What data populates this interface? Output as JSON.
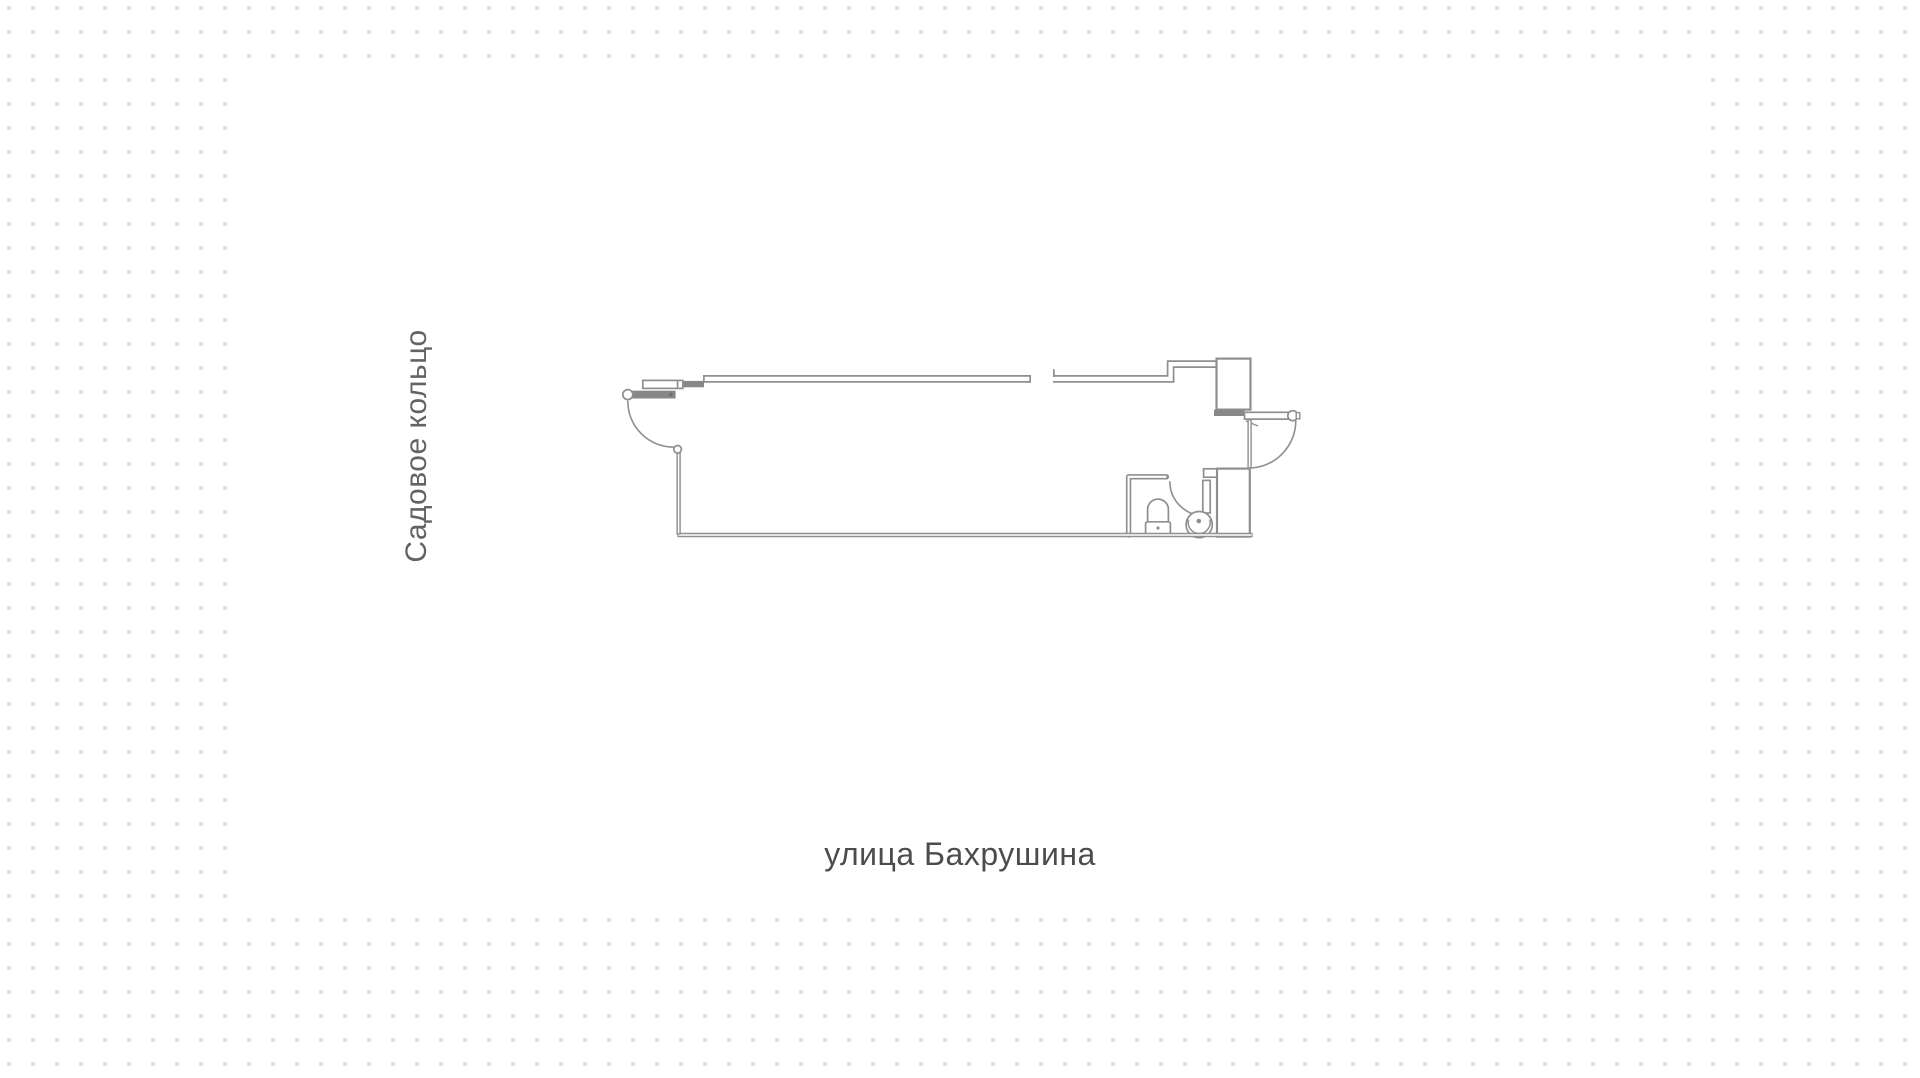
{
  "background": {
    "canvas_color": "#ffffff",
    "dot_color": "#e0e0e0",
    "dot_spacing_px": 24,
    "dot_size_px": 4
  },
  "labels": {
    "left_street": "Садовое кольцо",
    "bottom_street": "улица Бахрушина"
  },
  "plan": {
    "stroke_color": "#8f8f8f",
    "fill_color": "#ffffff",
    "rooms": [
      {
        "name": "main-hall"
      },
      {
        "name": "bathroom"
      }
    ],
    "doors": [
      {
        "name": "entrance-door-left"
      },
      {
        "name": "entrance-door-right"
      },
      {
        "name": "bathroom-door"
      }
    ],
    "fixtures": [
      {
        "name": "toilet"
      },
      {
        "name": "sink"
      }
    ],
    "shafts": [
      {
        "name": "upper-shaft"
      },
      {
        "name": "lower-shaft"
      }
    ]
  }
}
